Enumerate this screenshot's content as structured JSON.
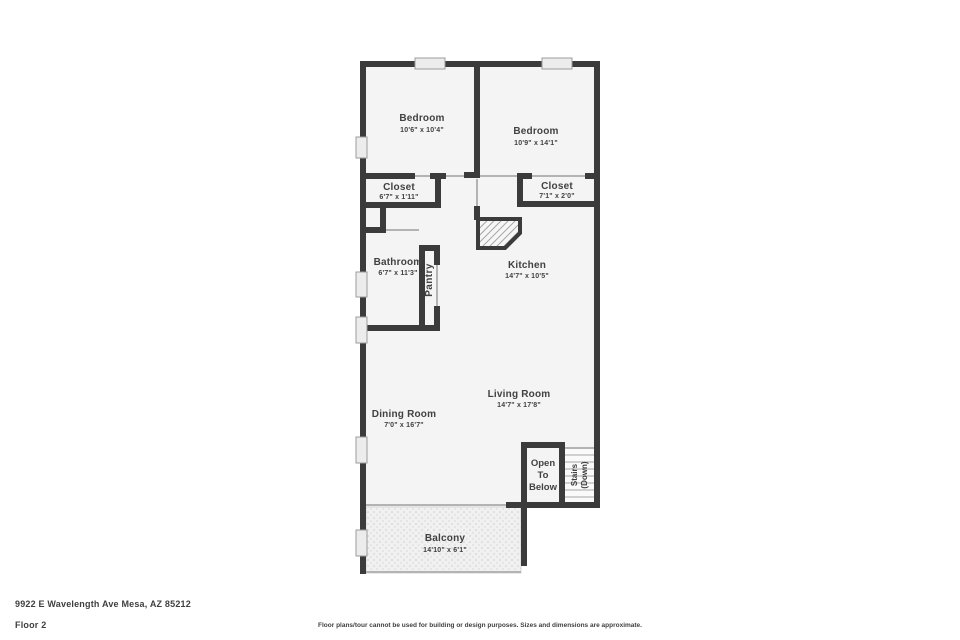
{
  "page": {
    "background": "#ffffff"
  },
  "plan": {
    "wall_color": "#3b3b3b",
    "interior_color": "#f4f4f4",
    "window_color": "#ececec",
    "opening_line_color": "#b3b3b3",
    "text_color": "#414141"
  },
  "rooms": [
    {
      "name": "Bedroom",
      "dims": "10'6\" x 10'4\""
    },
    {
      "name": "Bedroom",
      "dims": "10'9\" x 14'1\""
    },
    {
      "name": "Closet",
      "dims": "6'7\" x 1'11\""
    },
    {
      "name": "Closet",
      "dims": "7'1\" x 2'0\""
    },
    {
      "name": "Bathroom",
      "dims": "6'7\" x 11'3\""
    },
    {
      "name": "Pantry"
    },
    {
      "name": "Kitchen",
      "dims": "14'7\" x 10'5\""
    },
    {
      "name": "Living Room",
      "dims": "14'7\" x 17'8\""
    },
    {
      "name": "Dining Room",
      "dims": "7'0\" x 16'7\""
    },
    {
      "name": "Balcony",
      "dims": "14'10\" x 6'1\""
    }
  ],
  "open_to_below": {
    "lines": [
      "Open",
      "To",
      "Below"
    ]
  },
  "stairs": {
    "lines": [
      "Stairs",
      "(Down)"
    ]
  },
  "footer": {
    "address": "9922 E Wavelength Ave Mesa, AZ 85212",
    "floor_label": "Floor 2",
    "disclaimer": "Floor plans/tour cannot be used for building or design purposes. Sizes and dimensions are approximate."
  }
}
